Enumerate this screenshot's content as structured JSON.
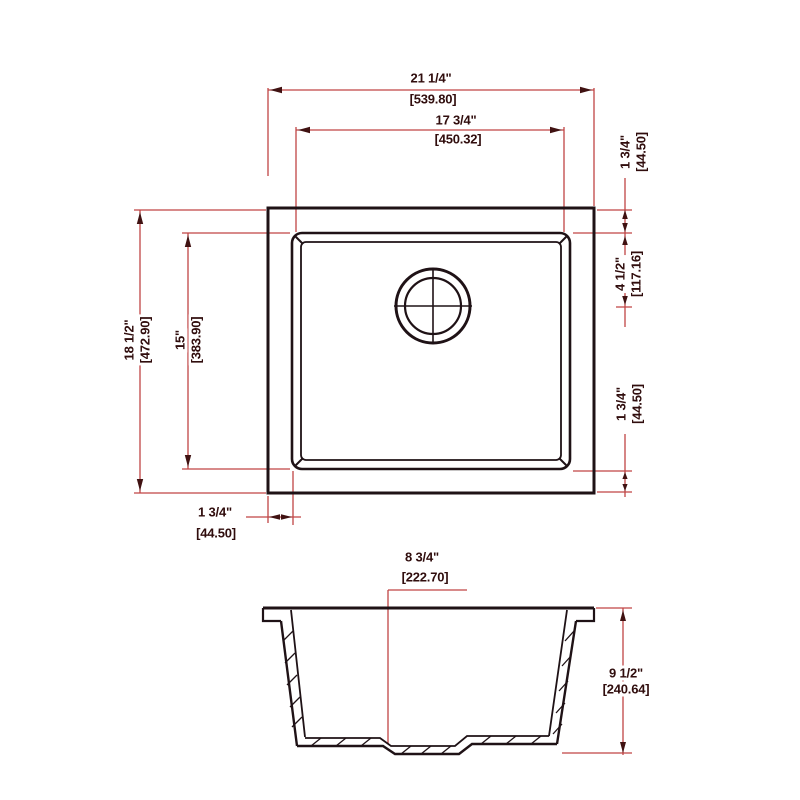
{
  "drawing_type": "sink installation dimension drawing",
  "colors": {
    "dimension_line": "#c04545",
    "object_line": "#1f1216",
    "text": "#300d0d",
    "arrow": "#401212",
    "background": "#ffffff"
  },
  "dims": {
    "top_outer": {
      "in": "21 1/4\"",
      "mm": "[539.80]"
    },
    "top_inner": {
      "in": "17 3/4\"",
      "mm": "[450.32]"
    },
    "right_rim_top": {
      "in": "1 3/4\"",
      "mm": "[44.50]"
    },
    "right_drain": {
      "in": "4 1/2\"",
      "mm": "[117.16]"
    },
    "right_rim_bottom": {
      "in": "1 3/4\"",
      "mm": "[44.50]"
    },
    "left_outer": {
      "in": "18 1/2\"",
      "mm": "[472.90]"
    },
    "left_inner": {
      "in": "15\"",
      "mm": "[383.90]"
    },
    "bottom_rim": {
      "in": "1 3/4\"",
      "mm": "[44.50]"
    },
    "section_drain": {
      "in": "8 3/4\"",
      "mm": "[222.70]"
    },
    "section_depth": {
      "in": "9 1/2\"",
      "mm": "[240.64]"
    }
  }
}
